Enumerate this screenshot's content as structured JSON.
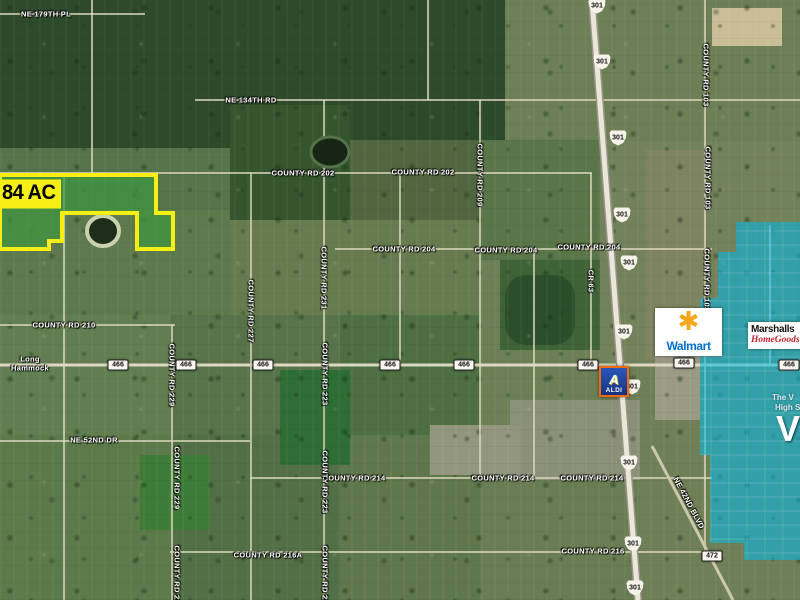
{
  "map": {
    "parcel": {
      "acreage_label": "84 AC",
      "fill_color": "#3f9540",
      "border_color": "#f7ef13"
    },
    "overlay": {
      "color": "#00b9e8",
      "texts": {
        "line1": "The V",
        "line2": "High S",
        "big_letter": "V"
      }
    },
    "businesses": {
      "walmart": {
        "name": "Walmart",
        "spark_glyph": "✱",
        "brand_blue": "#0071ce",
        "spark_orange": "#f9a51a"
      },
      "marshalls": {
        "name": "Marshalls",
        "homegoods": "HomeGoods",
        "homegoods_red": "#c6202e"
      },
      "aldi": {
        "name": "ALDI",
        "emblem_letter": "A",
        "border_orange": "#f06a12",
        "brand_blue": "#1d3f94"
      }
    },
    "route_shields": [
      {
        "number": "301",
        "style": "us",
        "positions": [
          [
            597,
            6
          ],
          [
            602,
            62
          ],
          [
            618,
            138
          ],
          [
            622,
            215
          ],
          [
            629,
            263
          ],
          [
            624,
            332
          ],
          [
            632,
            387
          ],
          [
            629,
            463
          ],
          [
            633,
            544
          ],
          [
            635,
            588
          ]
        ]
      },
      {
        "number": "466",
        "style": "state",
        "positions": [
          [
            118,
            365
          ],
          [
            186,
            365
          ],
          [
            263,
            365
          ],
          [
            390,
            365
          ],
          [
            464,
            365
          ],
          [
            588,
            365
          ],
          [
            684,
            363
          ],
          [
            789,
            365
          ]
        ]
      },
      {
        "number": "472",
        "style": "state",
        "positions": [
          [
            712,
            556
          ]
        ]
      }
    ],
    "road_labels": {
      "horizontal": [
        {
          "text": "NE 179TH PL",
          "x": 46,
          "y": 14
        },
        {
          "text": "NE 134TH RD",
          "x": 251,
          "y": 100
        },
        {
          "text": "COUNTY RD 202",
          "x": 303,
          "y": 173
        },
        {
          "text": "COUNTY RD 202",
          "x": 423,
          "y": 172
        },
        {
          "text": "COUNTY RD 204",
          "x": 404,
          "y": 249
        },
        {
          "text": "COUNTY RD 204",
          "x": 506,
          "y": 250
        },
        {
          "text": "COUNTY RD 204",
          "x": 589,
          "y": 247
        },
        {
          "text": "COUNTY RD 210",
          "x": 64,
          "y": 325
        },
        {
          "text": "Long Hammock",
          "x": 30,
          "y": 364,
          "w": 58
        },
        {
          "text": "NE 52ND DR",
          "x": 94,
          "y": 440
        },
        {
          "text": "COUNTY RD 214",
          "x": 354,
          "y": 478
        },
        {
          "text": "COUNTY RD 214",
          "x": 503,
          "y": 478
        },
        {
          "text": "COUNTY RD 214",
          "x": 592,
          "y": 478
        },
        {
          "text": "COUNTY RD 216A",
          "x": 268,
          "y": 555
        },
        {
          "text": "COUNTY RD 216",
          "x": 593,
          "y": 551
        }
      ],
      "vertical": [
        {
          "text": "COUNTY RD 209",
          "x": 480,
          "y": 175
        },
        {
          "text": "COUNTY RD 103",
          "x": 706,
          "y": 75
        },
        {
          "text": "COUNTY RD 103",
          "x": 708,
          "y": 178
        },
        {
          "text": "COUNTY RD 103",
          "x": 707,
          "y": 280
        },
        {
          "text": "CR 63",
          "x": 591,
          "y": 281
        },
        {
          "text": "COUNTY RD 231",
          "x": 324,
          "y": 278
        },
        {
          "text": "COUNTY RD 227",
          "x": 251,
          "y": 311
        },
        {
          "text": "COUNTY RD 229",
          "x": 172,
          "y": 375
        },
        {
          "text": "COUNTY RD 223",
          "x": 325,
          "y": 374
        },
        {
          "text": "COUNTY RD 229",
          "x": 177,
          "y": 478
        },
        {
          "text": "COUNTY RD 223",
          "x": 325,
          "y": 482
        },
        {
          "text": "COUNTY RD 229",
          "x": 177,
          "y": 577
        },
        {
          "text": "COUNTY RD 223",
          "x": 325,
          "y": 577
        },
        {
          "text": "NE 42ND BLVD",
          "x": 689,
          "y": 503,
          "angle": 62
        }
      ]
    }
  }
}
